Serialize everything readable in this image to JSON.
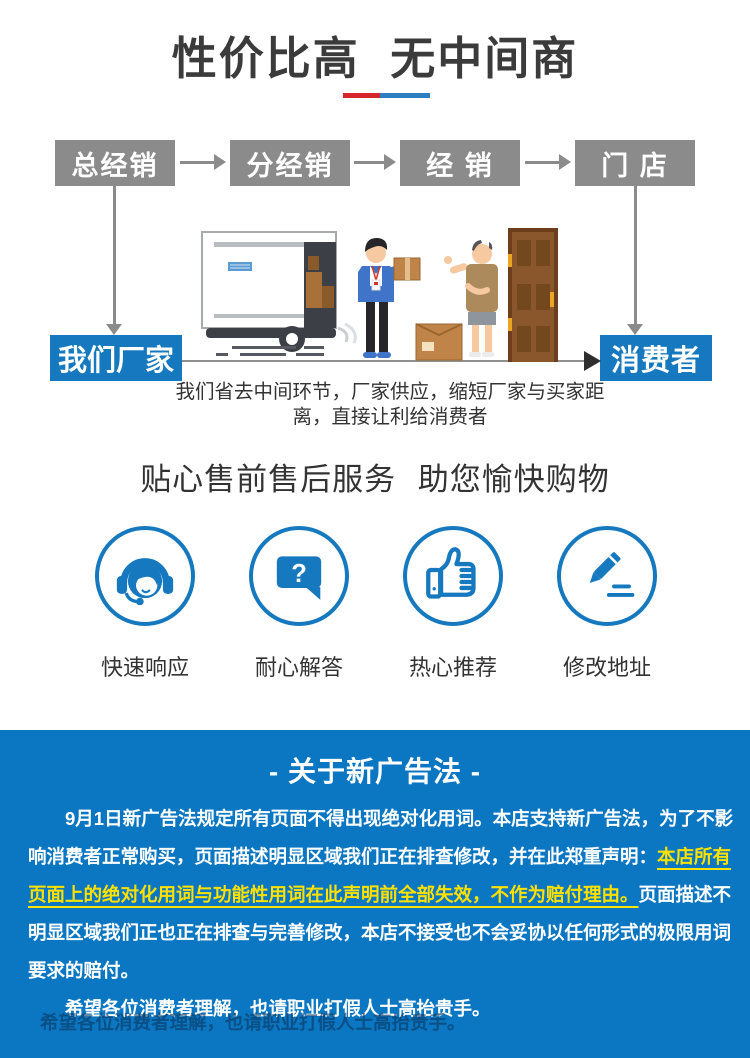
{
  "title": {
    "text": "性价比高 无中间商",
    "underline_red": "#d6252b",
    "underline_blue": "#2e7fc2"
  },
  "flow": {
    "box_color": "#8b8b8b",
    "accent_color": "#1678be",
    "boxes": [
      {
        "label": "总经销"
      },
      {
        "label": "分经销"
      },
      {
        "label": "经 销"
      },
      {
        "label": "门 店"
      }
    ],
    "factory_label": "我们厂家",
    "consumer_label": "消费者",
    "caption_line1": "我们省去中间环节，厂家供应，缩短厂家与买家距",
    "caption_line2": "离，直接让利给消费者",
    "illustration": "factory-direct-delivery-scene"
  },
  "services": {
    "title": "贴心售前售后服务 助您愉快购物",
    "accent_color": "#1678be",
    "items": [
      {
        "label": "快速响应",
        "icon": "headset-agent-icon"
      },
      {
        "label": "耐心解答",
        "icon": "question-bubble-icon"
      },
      {
        "label": "热心推荐",
        "icon": "thumbs-up-icon"
      },
      {
        "label": "修改地址",
        "icon": "pencil-edit-icon"
      }
    ]
  },
  "notice": {
    "bg_color": "#0b76c2",
    "highlight_color": "#ffe100",
    "header": "- 关于新广告法 -",
    "lines": [
      {
        "pre": "9月1日新广告法规定所有页面不得出现绝对化用词。本店支持新广告法，为了不影"
      },
      {
        "pre": "响消费者正常购买，页面描述明显区域我们正在排查修改，并在此郑重声明：",
        "hl": "本店所有"
      },
      {
        "hl": "页面上的绝对化用词与功能性用词在此声明前全部失效，不作为赔付理由。",
        "post": "页面描述不"
      },
      {
        "pre": "明显区域我们正也正在排查与完善修改，本店不接受也不会妥协以任何形式的极限用词"
      },
      {
        "pre": "要求的赔付。"
      },
      {
        "pre": "希望各位消费者理解，也请职业打假人士高抬贵手。"
      }
    ],
    "ghost_line": "希望各位消费者理解，也请职业打假人士高抬贵手。"
  }
}
